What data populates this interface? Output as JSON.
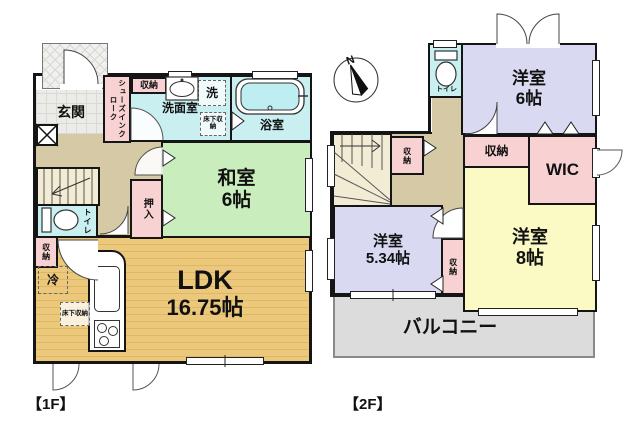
{
  "title": "floor-plan",
  "colors": {
    "wall": "#151515",
    "tatami_green": "#c9edbd",
    "wood_floor": "#ecc87c",
    "water_cyan": "#c9eff1",
    "closet_pink": "#f8d2d2",
    "western_lavender": "#d9daf2",
    "western_yellow": "#fbf9c4",
    "hall_tan": "#d5caa5",
    "stairs_cream": "#f2ecd4",
    "balcony_gray": "#dcdcdc",
    "tile_gray": "#ebebe7"
  },
  "floor1": {
    "caption": "【1F】",
    "rooms": {
      "genkan": "玄関",
      "shoes_closet": "シューズインクローク",
      "storage_top": "収納",
      "washroom": "洗面室",
      "laundry": "洗",
      "underfloor_wash": "床下収納",
      "bath": "浴室",
      "washitsu_name": "和室",
      "washitsu_size": "6帖",
      "oshiire": "押入",
      "toilet": "トイレ",
      "storage_left": "収納",
      "fridge": "冷",
      "underfloor_ldk": "床下収納",
      "ldk_name": "LDK",
      "ldk_size": "16.75帖"
    }
  },
  "floor2": {
    "caption": "【2F】",
    "compass": "N",
    "rooms": {
      "toilet": "トイレ",
      "bedroom6_name": "洋室",
      "bedroom6_size": "6帖",
      "storage_stairs": "収納",
      "storage_hall": "収納",
      "wic": "WIC",
      "bedroom534_name": "洋室",
      "bedroom534_size": "5.34帖",
      "storage_mid": "収納",
      "bedroom8_name": "洋室",
      "bedroom8_size": "8帖",
      "balcony": "バルコニー"
    }
  }
}
